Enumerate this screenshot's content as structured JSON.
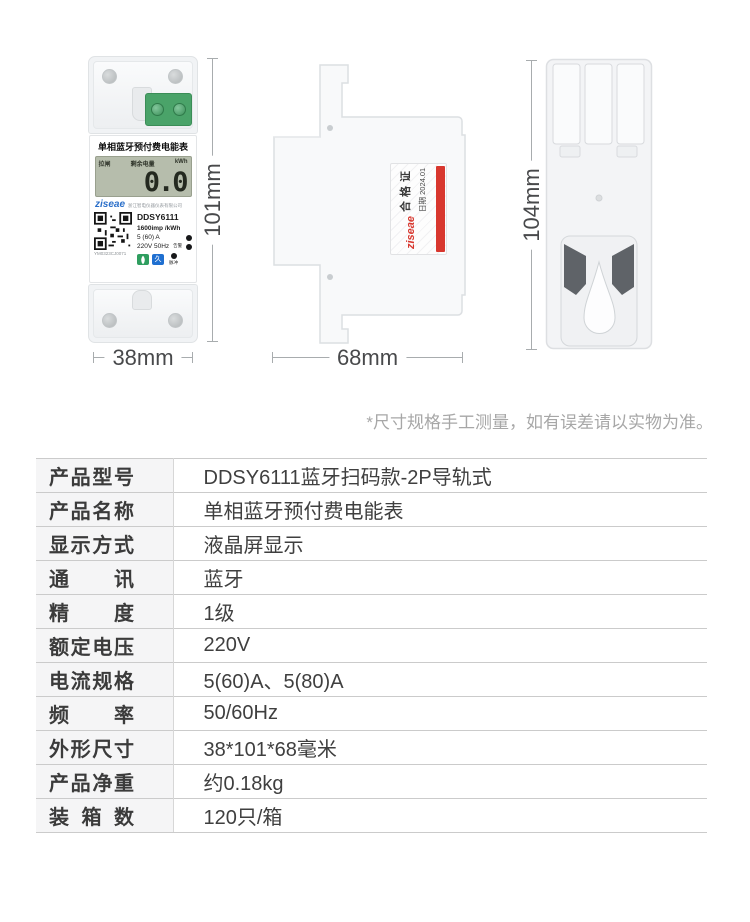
{
  "colors": {
    "brand_blue": "#2b6fc9",
    "sticker_red": "#d8372e",
    "terminal_green": "#4aa369",
    "button_green": "#2f9e5f",
    "button_blue": "#1f6fd0",
    "lcd_background": "#b6bdac"
  },
  "hero": {
    "note": "*尺寸规格手工测量，如有误差请以实物为准。",
    "front_view": {
      "width_dim": "38mm",
      "height_dim": "101mm",
      "panel_title": "单相蓝牙预付费电能表",
      "lcd": {
        "status": "拉闸",
        "remaining_label": "剩余电量",
        "unit": "kWh",
        "reading": "0.0"
      },
      "brand": "ziseae",
      "company": "浙江智电仪器仪表有限公司",
      "model": "DDSY6111",
      "impulse_rate": "1600imp /kWh",
      "current_spec": "5 (60) A",
      "voltage_spec": "220V 50Hz",
      "alarm_label": "告警",
      "pulse_label": "脉冲",
      "blue_button_glyph": "久",
      "serial": "YM0323CJ0071"
    },
    "side_view": {
      "depth_dim": "68mm",
      "label": {
        "brand": "ziseae",
        "cert_title": "合格证",
        "date": "日期 2024.01"
      }
    },
    "back_view": {
      "height_dim": "104mm"
    }
  },
  "spec_table": {
    "rows": [
      {
        "label": "产品型号",
        "value": "DDSY6111蓝牙扫码款-2P导轨式"
      },
      {
        "label": "产品名称",
        "value": "单相蓝牙预付费电能表"
      },
      {
        "label": "显示方式",
        "value": "液晶屏显示"
      },
      {
        "label": "通讯",
        "value": "蓝牙"
      },
      {
        "label": "精度",
        "value": "1级"
      },
      {
        "label": "额定电压",
        "value": "220V"
      },
      {
        "label": "电流规格",
        "value": "5(60)A、5(80)A"
      },
      {
        "label": "频率",
        "value": "50/60Hz"
      },
      {
        "label": "外形尺寸",
        "value": "38*101*68毫米"
      },
      {
        "label": "产品净重",
        "value": "约0.18kg"
      },
      {
        "label": "装箱数",
        "value": "120只/箱"
      }
    ]
  }
}
